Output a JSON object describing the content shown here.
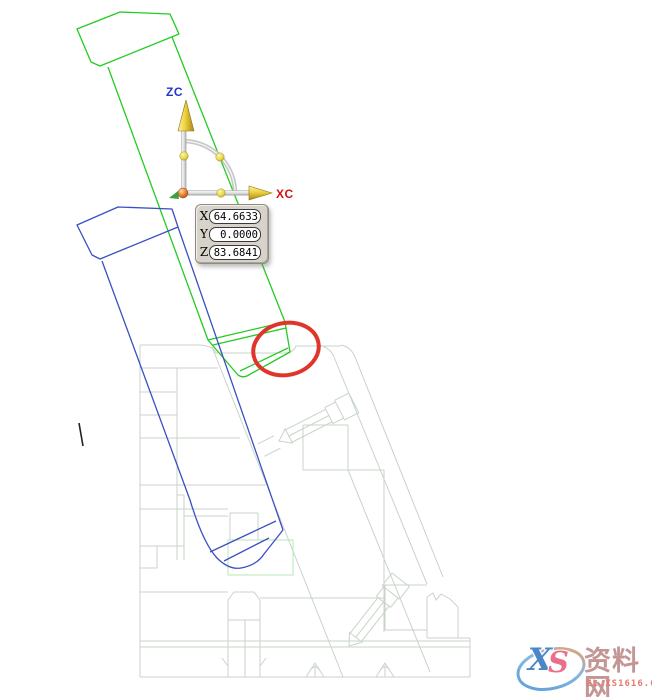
{
  "viewport": {
    "background": "#ffffff",
    "description": "CAD wireframe viewport with mold body, lifter pins, WCS triad and annotation"
  },
  "triad": {
    "z_axis_label": "ZC",
    "x_axis_label": "XC",
    "z_label_color": "#2238cc",
    "x_label_color": "#cc1616",
    "arrow_color": "#e8cf3e",
    "origin_ball_color": "#e0792a",
    "handle_ball_color": "#e9dd55",
    "shaft_color": "#d9d9d9",
    "arc_color": "#c6c6c6",
    "hidden_axis_arrow_color": "#3aa23a"
  },
  "coordinate_panel": {
    "panel_bg": "#d7d3cb",
    "fields": [
      {
        "label": "X",
        "value": "64.6633"
      },
      {
        "label": "Y",
        "value": "0.0000"
      },
      {
        "label": "Z",
        "value": "83.6841"
      }
    ]
  },
  "wireframe": {
    "body_line_color": "#c9d3c9",
    "green_pin_color": "#22cc22",
    "blue_pin_color": "#3a50c0",
    "highlight_rect_color": "#b7e6b7",
    "annotation_ellipse_color": "#e0352b",
    "tick_mark_color": "#222222"
  },
  "watermark": {
    "logo_letter_x": "X",
    "logo_letter_s": "S",
    "site_name": "资料网",
    "site_url": "ZL.XS1616.COM",
    "name_color": "#c49595",
    "url_color": "#e87870",
    "ellipse_blue": "#5b9bd5",
    "ellipse_orange": "#f2a05a"
  }
}
